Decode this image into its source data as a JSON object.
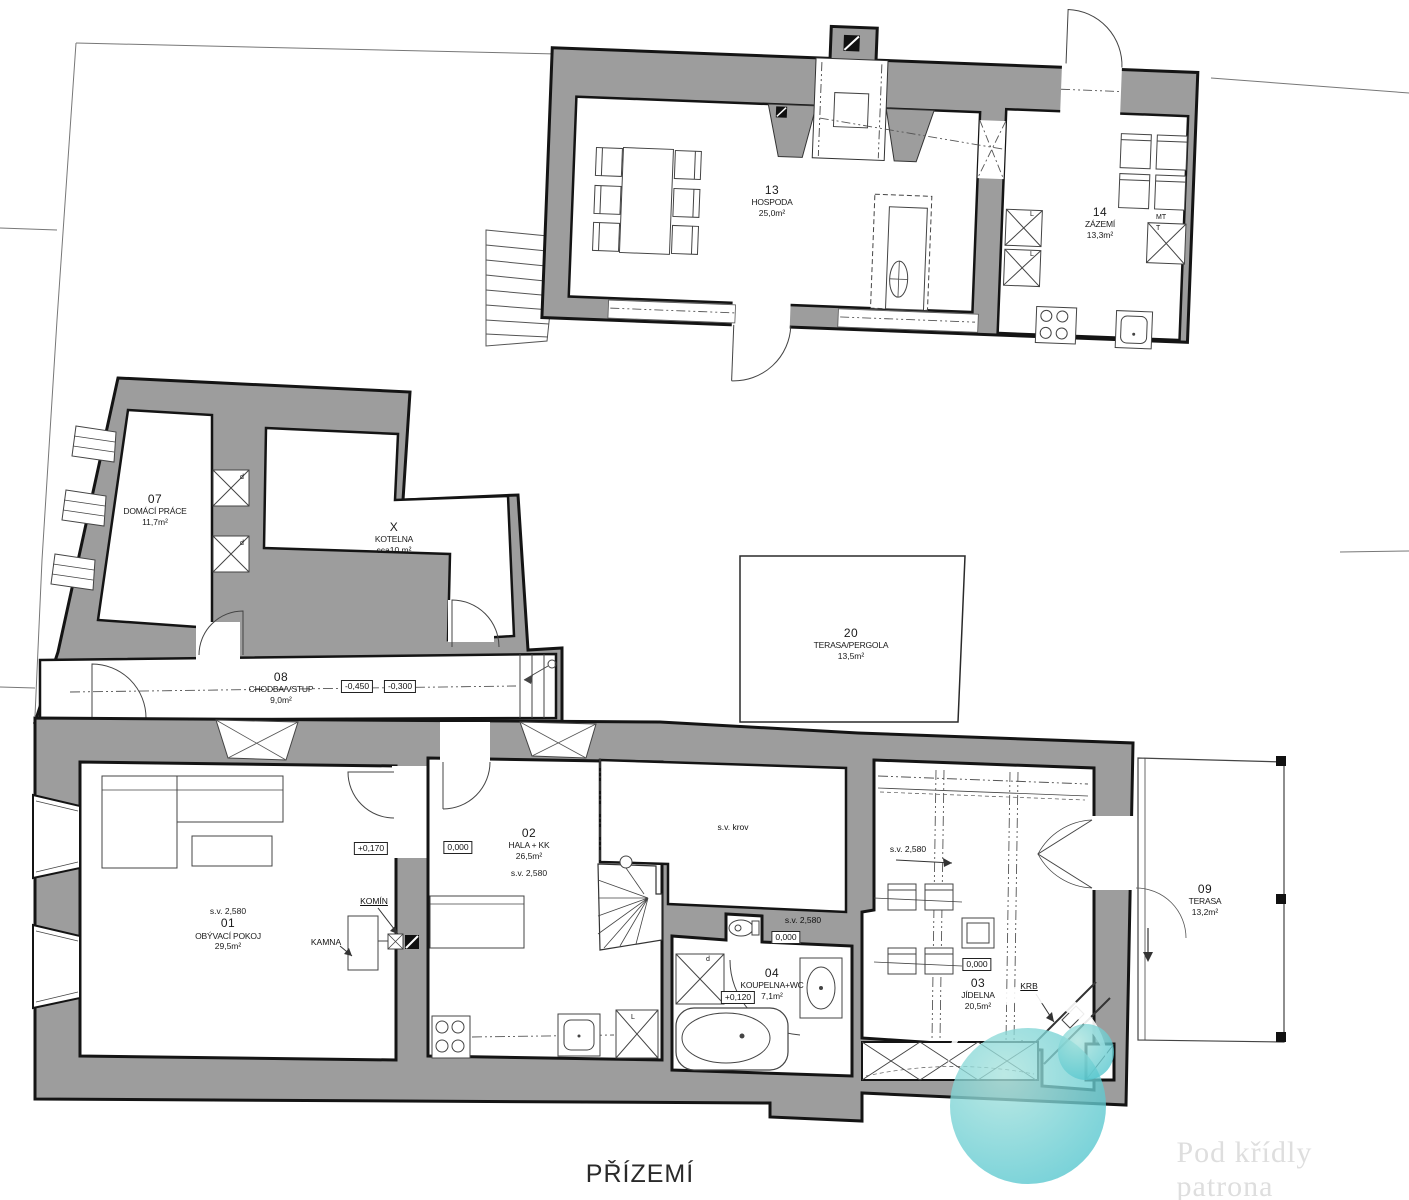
{
  "title": "PŘÍZEMÍ",
  "watermark": {
    "text": "Pod křídly patrona realit"
  },
  "colors": {
    "wall_gray": "#9d9d9d",
    "line_black": "#141414",
    "logo_teal": "#5ec7cb",
    "watermark_text": "#dedede"
  },
  "rooms": {
    "hospoda": {
      "number": "13",
      "name": "HOSPODA",
      "area": "25,0m²"
    },
    "zazemi": {
      "number": "14",
      "name": "ZÁZEMÍ",
      "area": "13,3m²"
    },
    "domaci_prace": {
      "number": "07",
      "name": "DOMÁCÍ PRÁCE",
      "area": "11,7m²"
    },
    "kotelna": {
      "number": "X",
      "name": "KOTELNA",
      "area": "cca10 m²"
    },
    "chodba": {
      "number": "08",
      "name": "CHODBA/VSTUP",
      "area": "9,0m²"
    },
    "terasa_pergola": {
      "number": "20",
      "name": "TERASA/PERGOLA",
      "area": "13,5m²"
    },
    "obyvaci_pokoj": {
      "number": "01",
      "name": "OBÝVACÍ POKOJ",
      "area": "29,5m²",
      "ceiling": "s.v. 2,580"
    },
    "hala": {
      "number": "02",
      "name": "HALA + KK",
      "area": "26,5m²",
      "ceiling": "s.v. 2,580"
    },
    "jidelna": {
      "number": "03",
      "name": "JÍDELNA",
      "area": "20,5m²",
      "ceiling": "s.v. 2,580"
    },
    "koupelna": {
      "number": "04",
      "name": "KOUPELNA+WC",
      "area": "7,1m²"
    },
    "terasa": {
      "number": "09",
      "name": "TERASA",
      "area": "13,2m²"
    }
  },
  "open_space": {
    "label": "s.v. krov"
  },
  "levels": {
    "hala": "0,000",
    "living_door": "+0,170",
    "corridor_left": "-0,450",
    "corridor_right": "-0,300",
    "bathroom": "+0,120",
    "wc_zone": "0,000",
    "wc_ceiling": "s.v. 2,580",
    "dining": "0,000"
  },
  "annotations": {
    "chimney": "KOMÍN",
    "stove": "KAMNA",
    "fireplace": "KRB"
  },
  "appliance_labels": {
    "fridge_a": "L",
    "fridge_b": "L",
    "fridge_c": "L",
    "mt": "MT",
    "t": "T",
    "duct_a": "d",
    "duct_b": "d",
    "duct_c": "d"
  }
}
